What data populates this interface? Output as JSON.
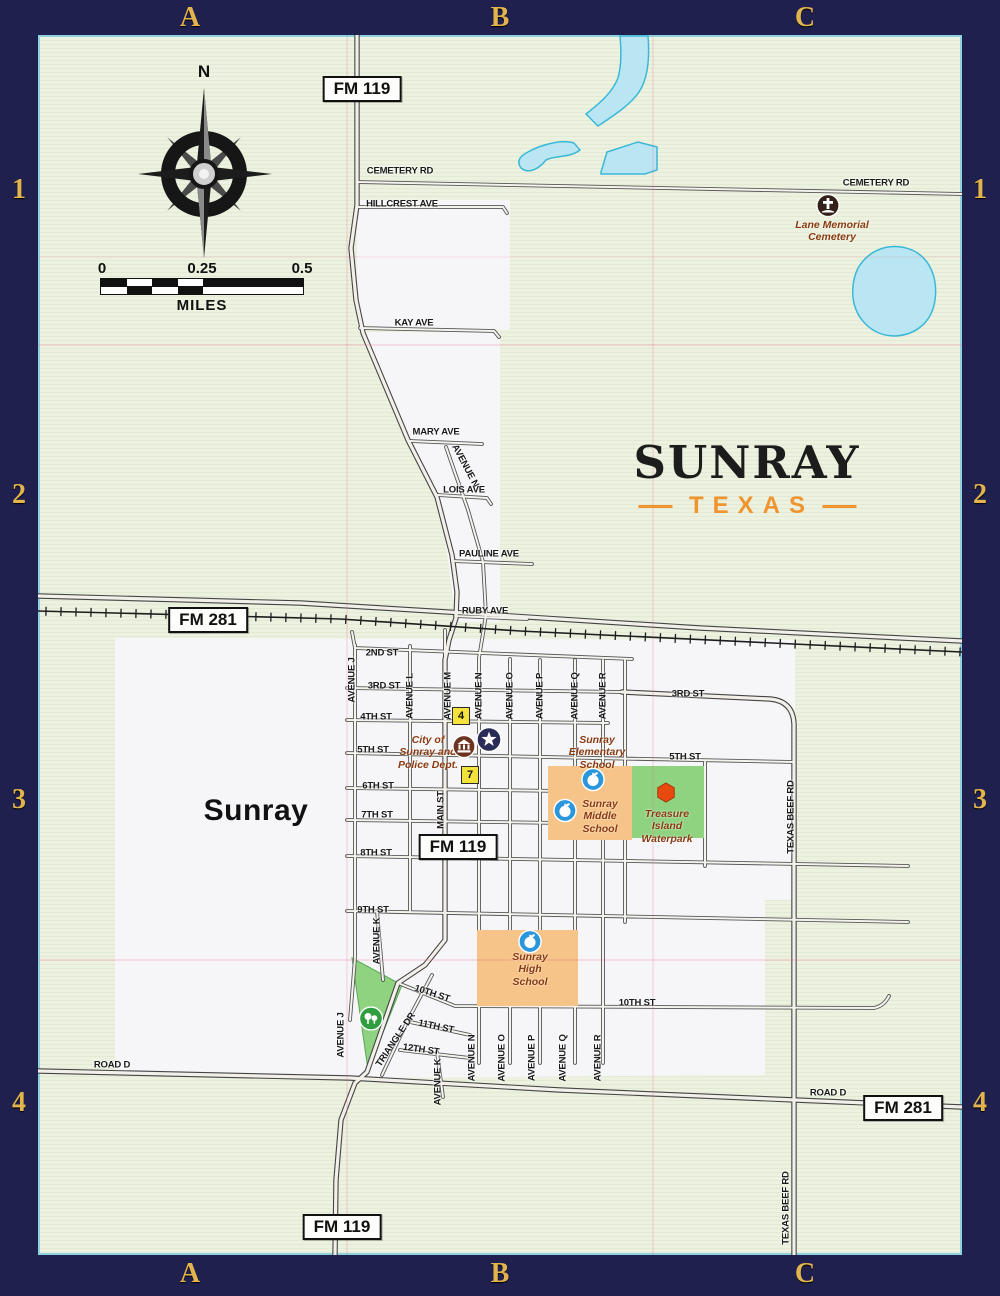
{
  "frame": {
    "columns": [
      "A",
      "B",
      "C"
    ],
    "rows": [
      "1",
      "2",
      "3",
      "4"
    ]
  },
  "title": {
    "city": "SUNRAY",
    "state": "TEXAS"
  },
  "map_labels": {
    "city_name": "Sunray",
    "compass_north": "N",
    "scale": {
      "ticks": [
        "0",
        "0.25",
        "0.5"
      ],
      "unit": "MILES"
    }
  },
  "map": {
    "highway_shields": [
      {
        "text": "FM 119",
        "x": 362,
        "y": 89
      },
      {
        "text": "FM 281",
        "x": 208,
        "y": 620
      },
      {
        "text": "FM 119",
        "x": 458,
        "y": 847
      },
      {
        "text": "FM 281",
        "x": 903,
        "y": 1108
      },
      {
        "text": "FM 119",
        "x": 342,
        "y": 1227
      }
    ],
    "street_labels": [
      {
        "text": "CEMETERY RD",
        "x": 400,
        "y": 171
      },
      {
        "text": "CEMETERY RD",
        "x": 876,
        "y": 183
      },
      {
        "text": "HILLCREST AVE",
        "x": 402,
        "y": 204
      },
      {
        "text": "KAY AVE",
        "x": 414,
        "y": 323
      },
      {
        "text": "MARY AVE",
        "x": 436,
        "y": 432
      },
      {
        "text": "AVENUE N",
        "x": 465,
        "y": 466,
        "rot": 62
      },
      {
        "text": "LOIS AVE",
        "x": 464,
        "y": 490
      },
      {
        "text": "PAULINE AVE",
        "x": 489,
        "y": 554
      },
      {
        "text": "RUBY AVE",
        "x": 485,
        "y": 611
      },
      {
        "text": "2ND ST",
        "x": 382,
        "y": 653
      },
      {
        "text": "3RD ST",
        "x": 384,
        "y": 686
      },
      {
        "text": "3RD ST",
        "x": 688,
        "y": 694
      },
      {
        "text": "4TH ST",
        "x": 376,
        "y": 717
      },
      {
        "text": "5TH ST",
        "x": 373,
        "y": 750
      },
      {
        "text": "5TH ST",
        "x": 685,
        "y": 757
      },
      {
        "text": "6TH ST",
        "x": 378,
        "y": 786
      },
      {
        "text": "7TH ST",
        "x": 377,
        "y": 815
      },
      {
        "text": "8TH ST",
        "x": 376,
        "y": 853
      },
      {
        "text": "9TH ST",
        "x": 373,
        "y": 910
      },
      {
        "text": "10TH ST",
        "x": 432,
        "y": 994,
        "rot": 18
      },
      {
        "text": "10TH ST",
        "x": 637,
        "y": 1003
      },
      {
        "text": "11TH ST",
        "x": 436,
        "y": 1027,
        "rot": 12
      },
      {
        "text": "12TH ST",
        "x": 421,
        "y": 1050,
        "rot": 8
      },
      {
        "text": "ROAD D",
        "x": 112,
        "y": 1065
      },
      {
        "text": "ROAD D",
        "x": 828,
        "y": 1093
      },
      {
        "text": "AVENUE J",
        "x": 352,
        "y": 680,
        "rot": -90
      },
      {
        "text": "AVENUE J",
        "x": 341,
        "y": 1035,
        "rot": -90
      },
      {
        "text": "AVENUE K",
        "x": 377,
        "y": 941,
        "rot": -90
      },
      {
        "text": "AVENUE K",
        "x": 438,
        "y": 1082,
        "rot": -90
      },
      {
        "text": "AVENUE L",
        "x": 410,
        "y": 696,
        "rot": -90
      },
      {
        "text": "AVENUE M",
        "x": 448,
        "y": 696,
        "rot": -90
      },
      {
        "text": "MAIN ST",
        "x": 441,
        "y": 810,
        "rot": -90
      },
      {
        "text": "AVENUE N",
        "x": 479,
        "y": 696,
        "rot": -90
      },
      {
        "text": "AVENUE N",
        "x": 472,
        "y": 1058,
        "rot": -90
      },
      {
        "text": "AVENUE O",
        "x": 510,
        "y": 696,
        "rot": -90
      },
      {
        "text": "AVENUE O",
        "x": 502,
        "y": 1058,
        "rot": -90
      },
      {
        "text": "AVENUE P",
        "x": 540,
        "y": 696,
        "rot": -90
      },
      {
        "text": "AVENUE P",
        "x": 532,
        "y": 1058,
        "rot": -90
      },
      {
        "text": "AVENUE Q",
        "x": 575,
        "y": 696,
        "rot": -90
      },
      {
        "text": "AVENUE Q",
        "x": 563,
        "y": 1058,
        "rot": -90
      },
      {
        "text": "AVENUE R",
        "x": 603,
        "y": 696,
        "rot": -90
      },
      {
        "text": "AVENUE R",
        "x": 598,
        "y": 1058,
        "rot": -90
      },
      {
        "text": "TRIANGLE DR",
        "x": 396,
        "y": 1040,
        "rot": -56
      },
      {
        "text": "TEXAS BEEF RD",
        "x": 791,
        "y": 817,
        "rot": -90
      },
      {
        "text": "TEXAS BEEF RD",
        "x": 786,
        "y": 1208,
        "rot": -90
      }
    ],
    "poi_labels": [
      {
        "name": "lane-memorial-cemetery",
        "lines": [
          "Lane Memorial",
          "Cemetery"
        ],
        "x": 832,
        "y": 219
      },
      {
        "name": "city-of-sunray-police-dept",
        "lines": [
          "City of",
          "Sunray and",
          "Police Dept."
        ],
        "x": 428,
        "y": 734
      },
      {
        "name": "sunray-elementary-school",
        "lines": [
          "Sunray",
          "Elementary",
          "School"
        ],
        "x": 597,
        "y": 734
      },
      {
        "name": "sunray-middle-school",
        "lines": [
          "Sunray",
          "Middle",
          "School"
        ],
        "x": 600,
        "y": 798
      },
      {
        "name": "treasure-island-waterpark",
        "lines": [
          "Treasure",
          "Island",
          "Waterpark"
        ],
        "x": 667,
        "y": 808
      },
      {
        "name": "sunray-high-school",
        "lines": [
          "Sunray",
          "High",
          "School"
        ],
        "x": 530,
        "y": 951
      }
    ],
    "markers": [
      {
        "type": "cemetery",
        "x": 828,
        "y": 208
      },
      {
        "type": "city-hall",
        "x": 464,
        "y": 749
      },
      {
        "type": "police",
        "x": 489,
        "y": 742
      },
      {
        "type": "school",
        "x": 593,
        "y": 782
      },
      {
        "type": "school",
        "x": 565,
        "y": 813
      },
      {
        "type": "school",
        "x": 530,
        "y": 944
      },
      {
        "type": "park",
        "x": 371,
        "y": 1021
      },
      {
        "type": "waterpark",
        "x": 666,
        "y": 795
      },
      {
        "type": "number",
        "label": "4",
        "x": 461,
        "y": 716
      },
      {
        "type": "number",
        "label": "7",
        "x": 470,
        "y": 775
      }
    ]
  },
  "colors": {
    "frame_navy": "#20204f",
    "grid_letter_gold": "#e2b44e",
    "map_green_bg": "#ecf2df",
    "city_white": "#f6f6f9",
    "water_blue": "#b9e6f2",
    "school_orange": "#f6c488",
    "park_green": "#8fd381",
    "title_orange": "#f0942f",
    "poi_brown": "#8a3a10",
    "marker_yellow": "#f3e13c"
  }
}
